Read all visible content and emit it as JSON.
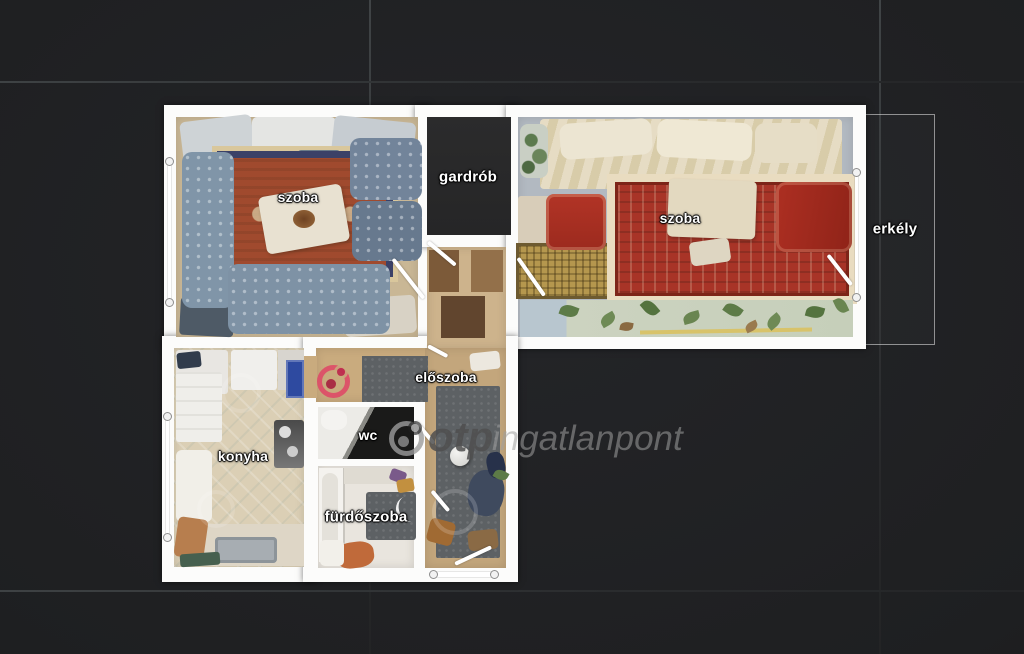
{
  "scene": {
    "description": "top-down 3D-scan floor plan of an apartment on dark tiled background",
    "background_color": "#1e1f21",
    "wall_color": "#fcfcfb",
    "grid_line_color": "#3a3d3f"
  },
  "rooms": [
    {
      "id": "szoba-1",
      "label": "szoba"
    },
    {
      "id": "gardrob",
      "label": "gardrób"
    },
    {
      "id": "szoba-2",
      "label": "szoba"
    },
    {
      "id": "erkely",
      "label": "erkély"
    },
    {
      "id": "eloszoba",
      "label": "előszoba"
    },
    {
      "id": "konyha",
      "label": "konyha"
    },
    {
      "id": "wc",
      "label": "wc"
    },
    {
      "id": "furdoszoba",
      "label": "fürdőszoba"
    }
  ],
  "watermark": {
    "brand_bold": "otp",
    "brand_light": "ingatlanpont",
    "logo": "otp-ingatlanpont-circle-logo",
    "colors": {
      "bold_text": "#4f4f4f",
      "light_text": "#a0a0a0",
      "red_logo": "#de4866",
      "gray_logo": "#9a9a9a"
    }
  },
  "palette": {
    "room1_rug_field": "#a04a2e",
    "room1_rug_border": "#3b4167",
    "sofa_blue": "#8095a8",
    "room2_rug_field": "#a83427",
    "room2_rug_border": "#e9dcc0",
    "gold_rug": "#b5974e",
    "bed_cream": "#ddd3b8",
    "red_armchair": "#b23426",
    "corridor_floor": "#c7a97e",
    "kitchen_floor": "#dbcfb5",
    "mat_gray": "#5d6164",
    "dark_room": "#29292a"
  }
}
